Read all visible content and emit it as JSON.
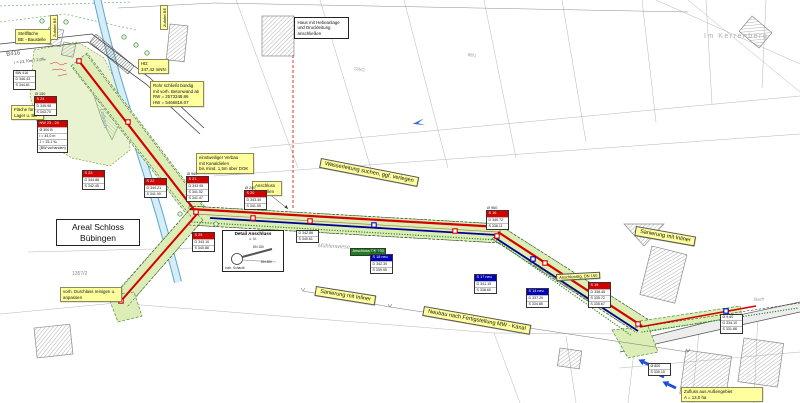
{
  "colors": {
    "label_yellow": "#ffff9e",
    "corridor_green": "#dcedb6",
    "corridor_border": "#4d8f3f",
    "be_green": "#e9f3d2",
    "red": "#d40000",
    "blue": "#0000bb",
    "dark_blue_pipe": "#000090",
    "stream_blue": "#5aa7d0",
    "stream_fill": "#d6ecf7",
    "road_edge": "#444444",
    "parcel_gray": "#b5b5b5",
    "arrow_blue": "#1d4fd6"
  },
  "street_texts": [
    {
      "name": "road-label-b416",
      "text": "B416",
      "x": 6,
      "y": 52,
      "rot": -7,
      "size": 6,
      "color": "#666"
    },
    {
      "name": "road-measure-label",
      "text": "l = 23,70m / 2,0‰",
      "x": 14,
      "y": 60,
      "rot": -7,
      "size": 4,
      "color": "#444"
    },
    {
      "name": "stream-label-lorbach",
      "text": "Lorbach",
      "x": 104,
      "y": 108,
      "rot": 78,
      "size": 5.5,
      "color": "#7a9ab0",
      "italic": true
    },
    {
      "name": "street-label-im-kerrenberg",
      "text": "Im Kerrenberg",
      "x": 704,
      "y": 33,
      "size": 7,
      "color": "#b0b0b0",
      "ls": 1.5
    },
    {
      "name": "field-label-muehlenwiese",
      "text": "Mühlenwiese",
      "x": 318,
      "y": 243,
      "rot": 3,
      "size": 5.5,
      "color": "#999",
      "italic": true
    },
    {
      "name": "parcel-number",
      "text": "1357/2",
      "x": 72,
      "y": 271,
      "size": 5,
      "color": "#888"
    },
    {
      "name": "parcel-number",
      "text": "136/2",
      "x": 354,
      "y": 66,
      "rot": 8,
      "size": 4.5,
      "color": "#9a9a9a"
    },
    {
      "name": "parcel-number",
      "text": "98/1",
      "x": 468,
      "y": 52,
      "rot": 8,
      "size": 4.5,
      "color": "#9a9a9a"
    },
    {
      "name": "house-connections-note",
      "text": "ca. 10 Stk. Anschlüsse\n(Sanierung geplant)",
      "x": 530,
      "y": 258,
      "rot": 33,
      "size": 4,
      "color": "#333"
    },
    {
      "name": "stream-label-bach",
      "text": "Bach",
      "x": 754,
      "y": 297,
      "rot": -4,
      "size": 4.5,
      "color": "#999"
    }
  ],
  "banners": [
    {
      "name": "banner-wasserleitung",
      "text": "Wasserleitung suchen, ggf. verlegen",
      "x": 321,
      "y": 158,
      "rot": 11
    },
    {
      "name": "banner-sanierung-inliner-1",
      "text": "Sanierung mit Inliner",
      "x": 316,
      "y": 286,
      "rot": 9
    },
    {
      "name": "banner-neubau-mw-kanal",
      "text": "Neubau nach Fertigstellung MW - Kanal",
      "x": 424,
      "y": 306,
      "rot": 10
    },
    {
      "name": "banner-sanierung-inliner-2",
      "text": "Sanierung mit Inliner",
      "x": 636,
      "y": 226,
      "rot": 10
    },
    {
      "name": "banner-anschlussleitung",
      "text": "Anschlussltg. DN 150",
      "x": 556,
      "y": 274,
      "rot": -3,
      "small": true
    }
  ],
  "notes": [
    {
      "name": "note-stellflaeche-be",
      "text": "Stellfläche\nBE - Baustelle",
      "x": 15,
      "y": 29,
      "w": 30
    },
    {
      "name": "note-hd",
      "text": "HD:\n347,42 mNN",
      "x": 138,
      "y": 59
    },
    {
      "name": "note-rohr-betonwand",
      "text": "Rohr schließt bündig\nmit vorh. Betonwand ab\nRW = 2573348.86\nHW = 5466818.07",
      "x": 150,
      "y": 81,
      "w": 48
    },
    {
      "name": "note-flaeche-lager-be",
      "text": "Fläche für\nLager u. BE",
      "x": 11,
      "y": 105,
      "w": 27
    },
    {
      "name": "note-verbau-kanaldielen",
      "text": "einstweiliger Verbau\nmit Kanaldielen\nbis mind. 1,5m über DOK",
      "x": 196,
      "y": 153,
      "w": 52
    },
    {
      "name": "note-anschluss-herstellen",
      "text": "Anschluss\nherstellen",
      "x": 252,
      "y": 181,
      "w": 24
    },
    {
      "name": "note-durchlass",
      "text": "vorh. Durchlass reinigen u. anpassen",
      "x": 60,
      "y": 287,
      "w": 56
    },
    {
      "name": "note-zufluss-aussengebiet",
      "text": "Zufluss aus Außengebiet\nA = 13,0 ha",
      "x": 681,
      "y": 387,
      "w": 76
    }
  ],
  "strips": [
    {
      "name": "strip-zufahrt-1",
      "text": "Zufahrt BE",
      "x": 50,
      "y": 40,
      "rot": -90
    },
    {
      "name": "strip-zufahrt-2",
      "text": "Zufahrt BE",
      "x": 160,
      "y": 30,
      "rot": -90
    }
  ],
  "plates": [
    {
      "name": "area-label-schloss-buebingen",
      "text": "Areal Schloss\nBübingen",
      "x": 56,
      "y": 219,
      "w": 74
    },
    {
      "name": "note-haus-hebeanlage",
      "text": "Haus mit Hebeanlage\nund Druckleitung\nanschließen",
      "x": 294,
      "y": 17,
      "w": 48,
      "sm": true
    }
  ],
  "detail": {
    "title": "Detail Anschluss",
    "scale": "o. M.",
    "label_dn150": "DN 150",
    "label_dn300": "DN 300",
    "label_schacht": "vorh. Schacht"
  },
  "tables": [
    {
      "name": "manhole-table-bw416",
      "x": 13,
      "y": 70,
      "color": "none",
      "rows": [
        "BW 416",
        "D 346.43",
        "S 344.61"
      ]
    },
    {
      "name": "manhole-table-s24",
      "x": 34,
      "y": 92,
      "header": "S 24",
      "color": "red",
      "dia": "Ø 150",
      "rows": [
        "D 345.98",
        "S 343.70"
      ]
    },
    {
      "name": "reach-table-nw-23-24",
      "x": 37,
      "y": 120,
      "header": "NW 23 - 24",
      "color": "red",
      "rows": [
        "Ø 300 B",
        "l = 44,0 m",
        "J = 15,1 ‰",
        "(BW vorhanden)"
      ]
    },
    {
      "name": "manhole-table-s23",
      "x": 82,
      "y": 170,
      "header": "S 23",
      "color": "red",
      "rows": [
        "D 344.88",
        "S 342.45"
      ]
    },
    {
      "name": "manhole-table-s22",
      "x": 144,
      "y": 178,
      "header": "S 22",
      "color": "red",
      "rows": [
        "D 344.21",
        "S 341.90"
      ]
    },
    {
      "name": "manhole-table-s21",
      "x": 186,
      "y": 172,
      "header": "S 21",
      "color": "red",
      "dia": "Ø 960",
      "rows": [
        "D 343.95",
        "S 341.52",
        "S 341.47"
      ]
    },
    {
      "name": "manhole-table-s20",
      "x": 244,
      "y": 186,
      "header": "S 20",
      "color": "red",
      "dia": "Ø 240",
      "rows": [
        "D 343.40",
        "S 341.05"
      ]
    },
    {
      "name": "manhole-table-s25",
      "x": 192,
      "y": 232,
      "header": "S 25",
      "color": "red",
      "rows": [
        "D 343.10",
        "S 340.88"
      ]
    },
    {
      "name": "manhole-table-s19",
      "x": 296,
      "y": 227,
      "color": "none",
      "rows": [
        "D 342.86",
        "S 340.61"
      ]
    },
    {
      "name": "connection-label-dn150",
      "x": 350,
      "y": 239,
      "header": "Anschluss DN 150",
      "color": "green",
      "rows": []
    },
    {
      "name": "manhole-table-s18",
      "x": 370,
      "y": 250,
      "header": "S 18 neu",
      "color": "blue",
      "dia": "Ø 960",
      "rows": [
        "D 342.30",
        "S 339.95"
      ]
    },
    {
      "name": "manhole-table-s17",
      "x": 474,
      "y": 274,
      "header": "S 17 neu",
      "color": "blue",
      "rows": [
        "D 341.15",
        "S 338.60"
      ]
    },
    {
      "name": "manhole-table-s16",
      "x": 486,
      "y": 206,
      "header": "S 16",
      "color": "red",
      "dia": "Ø 960",
      "rows": [
        "D 340.72",
        "S 338.11"
      ]
    },
    {
      "name": "manhole-table-s15",
      "x": 588,
      "y": 282,
      "header": "S 15",
      "color": "red",
      "rows": [
        "D 338.45",
        "S 335.72",
        "S 335.67"
      ]
    },
    {
      "name": "manhole-table-s14",
      "x": 526,
      "y": 288,
      "header": "S 14 neu",
      "color": "blue",
      "rows": [
        "D 337.20",
        "S 334.85"
      ]
    },
    {
      "name": "manhole-table-s13",
      "x": 720,
      "y": 314,
      "color": "none",
      "rows": [
        "Ø 9,60",
        "D 334.10",
        "S 331.88"
      ]
    },
    {
      "name": "inflow-table",
      "x": 648,
      "y": 360,
      "color": "none",
      "rows": [
        "Ø 800",
        "S 330.15"
      ]
    }
  ]
}
